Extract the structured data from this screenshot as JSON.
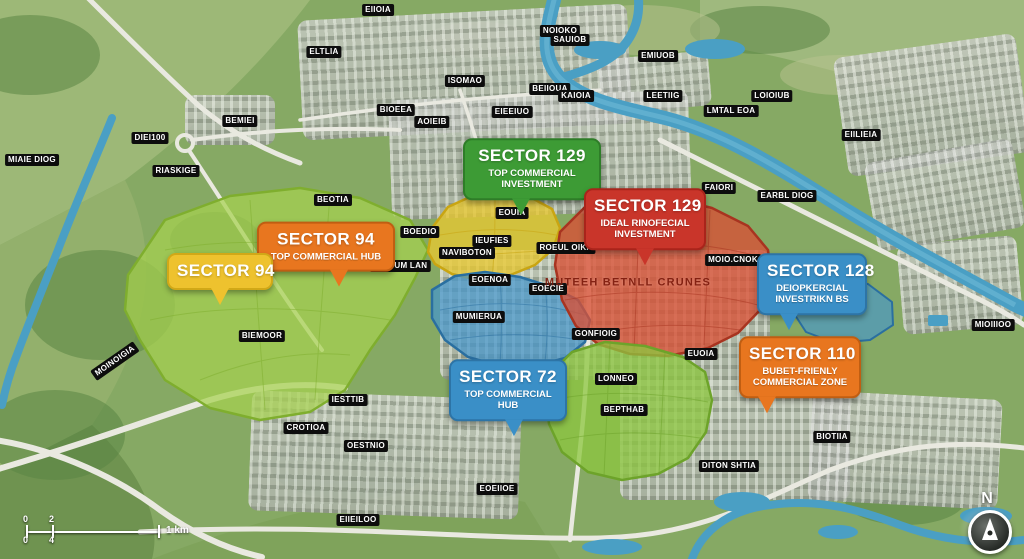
{
  "colors": {
    "callout_green": "#3d9b35",
    "callout_red": "#c9352a",
    "callout_orange": "#e8761f",
    "callout_yellow": "#eec22e",
    "callout_blue": "#3a8fc7",
    "zone_light_green": "#a6d14f",
    "zone_yellow": "#e8c832",
    "zone_blue": "#4596cc",
    "zone_red": "#d94f35",
    "zone_green": "#8cc63f",
    "river_blue": "#4a9fc4",
    "label_chip_bg": "#0d0d0d"
  },
  "callouts": [
    {
      "name": "callout-sector-129-green",
      "title": "SECTOR 129",
      "subtitle": "TOP COMMERCIAL INVESTMENT",
      "color": "#3d9b35",
      "border": "#2e7d28",
      "x": 532,
      "y": 200,
      "w": 118,
      "tail_x": "42%"
    },
    {
      "name": "callout-sector-129-red",
      "title": "SECTOR 129",
      "subtitle": "IDEAL RINOFECIAL INVESTMENT",
      "color": "#c9352a",
      "border": "#a9241b",
      "x": 645,
      "y": 250,
      "w": 102,
      "tail_x": "50%"
    },
    {
      "name": "callout-sector-94-orange",
      "title": "SECTOR 94",
      "subtitle": "TOP COMMERCIAL HUB",
      "color": "#e8761f",
      "border": "#c05e12",
      "x": 326,
      "y": 272,
      "w": 118,
      "tail_x": "60%"
    },
    {
      "name": "callout-sector-94-yellow",
      "title": "SECTOR 94",
      "subtitle": "",
      "color": "#eec22e",
      "border": "#d1a817",
      "x": 220,
      "y": 290,
      "w": 86,
      "tail_x": "50%"
    },
    {
      "name": "callout-sector-128-blue",
      "title": "SECTOR 128",
      "subtitle": "DEIOPKERCIAL INVESTRIKN BS",
      "color": "#3a8fc7",
      "border": "#2d74a6",
      "x": 812,
      "y": 315,
      "w": 90,
      "tail_x": "28%"
    },
    {
      "name": "callout-sector-110-orange",
      "title": "SECTOR 110",
      "subtitle": "BUBET-FRIENLY COMMERCIAL ZONE",
      "color": "#e8761f",
      "border": "#c05e12",
      "x": 800,
      "y": 398,
      "w": 102,
      "tail_x": "22%"
    },
    {
      "name": "callout-sector-72-blue",
      "title": "SECTOR 72",
      "subtitle": "TOP COMMERCIAL HUB",
      "color": "#3a8fc7",
      "border": "#2d74a6",
      "x": 508,
      "y": 421,
      "w": 98,
      "tail_x": "55%"
    }
  ],
  "area_labels": [
    {
      "text": "EIIOIA",
      "x": 378,
      "y": 10
    },
    {
      "text": "ELTLIA",
      "x": 324,
      "y": 52
    },
    {
      "text": "NOIOKO",
      "x": 560,
      "y": 31
    },
    {
      "text": "SAUIOB",
      "x": 570,
      "y": 40
    },
    {
      "text": "EMIUOB",
      "x": 658,
      "y": 56
    },
    {
      "text": "ISOMAO",
      "x": 465,
      "y": 81
    },
    {
      "text": "BEIIOUA",
      "x": 550,
      "y": 89
    },
    {
      "text": "KAIOIA",
      "x": 576,
      "y": 96
    },
    {
      "text": "LEETIIG",
      "x": 663,
      "y": 96
    },
    {
      "text": "LOIOIUB",
      "x": 772,
      "y": 96
    },
    {
      "text": "BIOEEA",
      "x": 396,
      "y": 110
    },
    {
      "text": "EIEEIUO",
      "x": 512,
      "y": 112
    },
    {
      "text": "LMTAL EOA",
      "x": 731,
      "y": 111
    },
    {
      "text": "AOIEIB",
      "x": 432,
      "y": 122
    },
    {
      "text": "BEMIEI",
      "x": 240,
      "y": 121
    },
    {
      "text": "EIILIEIA",
      "x": 861,
      "y": 135
    },
    {
      "text": "DIEI100",
      "x": 150,
      "y": 138
    },
    {
      "text": "MIAIE DIOG",
      "x": 32,
      "y": 160
    },
    {
      "text": "RIASKIGE",
      "x": 176,
      "y": 171
    },
    {
      "text": "FAIORI",
      "x": 719,
      "y": 188
    },
    {
      "text": "EARBL DIOG",
      "x": 787,
      "y": 196
    },
    {
      "text": "BEOTIA",
      "x": 333,
      "y": 200
    },
    {
      "text": "EOUIA",
      "x": 512,
      "y": 213
    },
    {
      "text": "BOEDIO",
      "x": 420,
      "y": 232
    },
    {
      "text": "IEUFIES",
      "x": 492,
      "y": 241
    },
    {
      "text": "ROEUL OIKA",
      "x": 566,
      "y": 248
    },
    {
      "text": "NAVIBOTON",
      "x": 467,
      "y": 253
    },
    {
      "text": "MOIO.CNOK",
      "x": 733,
      "y": 260
    },
    {
      "text": "IROGUM LAN",
      "x": 400,
      "y": 266
    },
    {
      "text": "EOENOA",
      "x": 490,
      "y": 280
    },
    {
      "text": "EOECIE",
      "x": 548,
      "y": 289
    },
    {
      "text": "MUTEEH BETNLL CRUNES",
      "x": 628,
      "y": 283,
      "variant": "zone"
    },
    {
      "text": "MUMIERUA",
      "x": 479,
      "y": 317
    },
    {
      "text": "MIOIIIOO",
      "x": 993,
      "y": 325
    },
    {
      "text": "GONFIOIG",
      "x": 596,
      "y": 334
    },
    {
      "text": "BIEMOOR",
      "x": 262,
      "y": 336
    },
    {
      "text": "EUOIA",
      "x": 701,
      "y": 354
    },
    {
      "text": "MOINOIGIA",
      "x": 115,
      "y": 361,
      "rotate": -35
    },
    {
      "text": "LONNEO",
      "x": 616,
      "y": 379
    },
    {
      "text": "IESTTIB",
      "x": 348,
      "y": 400
    },
    {
      "text": "BEPTHAB",
      "x": 624,
      "y": 410
    },
    {
      "text": "CROTIOA",
      "x": 306,
      "y": 428
    },
    {
      "text": "BIOTIIA",
      "x": 832,
      "y": 437
    },
    {
      "text": "OESTNIO",
      "x": 366,
      "y": 446
    },
    {
      "text": "DITON SHTIA",
      "x": 729,
      "y": 466
    },
    {
      "text": "EOEIIOE",
      "x": 497,
      "y": 489
    },
    {
      "text": "EIIEILOO",
      "x": 358,
      "y": 520
    }
  ],
  "scale_bar": {
    "labels_top": [
      "0",
      "2"
    ],
    "label_right": "1 km",
    "labels_bottom": [
      "0",
      "4"
    ]
  },
  "compass": {
    "north_label": "N"
  }
}
